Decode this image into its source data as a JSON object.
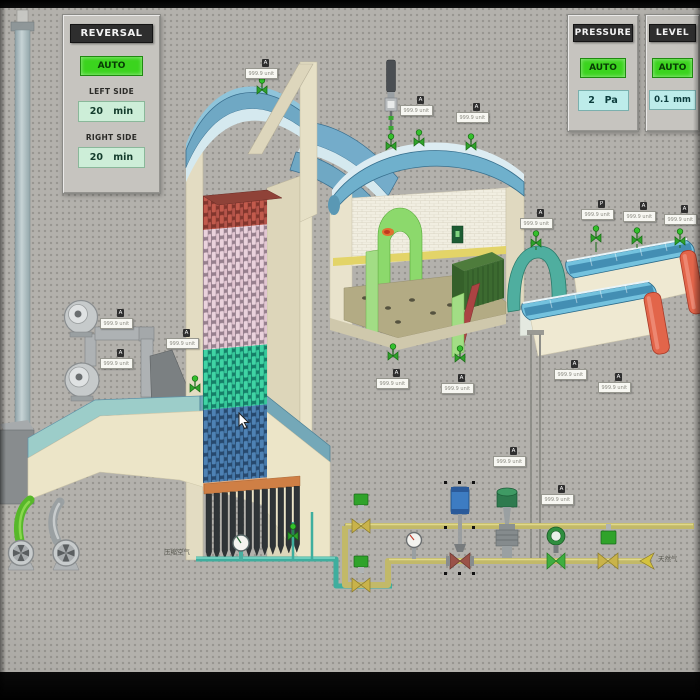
{
  "panels": {
    "reversal": {
      "title": "REVERSAL",
      "mode": "AUTO",
      "left_label": "LEFT SIDE",
      "left_value": "20",
      "left_unit": "min",
      "right_label": "RIGHT SIDE",
      "right_value": "20",
      "right_unit": "min"
    },
    "pressure": {
      "title": "PRESSURE",
      "mode": "AUTO",
      "value": "2",
      "unit": "Pa"
    },
    "level": {
      "title": "LEVEL",
      "mode": "AUTO",
      "value": "0.1",
      "unit": "mm"
    }
  },
  "pipe_labels": {
    "compressed_air": "压缩空气",
    "natural_gas": "天然气"
  },
  "sensors": {
    "readout": "999.9 unit",
    "tag_a": "A",
    "tag_p": "P"
  },
  "colors": {
    "auto_green": "#3bd41e",
    "mint_display": "#cdeed8",
    "cyan_display": "#bdecea",
    "panel_header": "#2e2e2e",
    "pipe_yellow": "#c2b969",
    "pipe_teal": "#3fae9e",
    "valve_green": "#2fa32a",
    "vessel_red_cap": "#e2654a",
    "roof_blue": "#6fb0cc",
    "checker_red": "#c25a4c",
    "checker_pink": "#e7ccd8",
    "checker_teal": "#3fd4a4",
    "checker_blue": "#4e82b4"
  }
}
